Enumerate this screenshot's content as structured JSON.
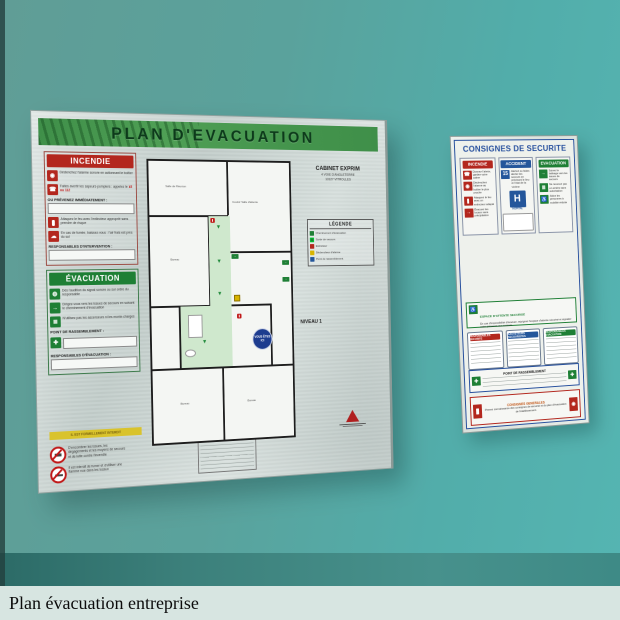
{
  "caption": {
    "text": "Plan évacuation entreprise"
  },
  "board": {
    "title": "PLAN  D'EVACUATION",
    "client_name": "CABINET EXPRIM",
    "client_address1": "4 VOIE D'ANGLETERRE",
    "client_address2": "13127 VITROLLES",
    "level": "NIVEAU 1",
    "incendie": {
      "header": "INCENDIE",
      "row1": "Déclenchez l'alarme sonore en actionnant le boîtier",
      "row2": "Faites avertir les sapeurs-pompiers : appelez le ",
      "row2_numbers": "18 ou 112",
      "notify": "OU PRÉVENEZ IMMÉDIATEMENT :",
      "row3": "Attaquez le feu avec l'extincteur approprié sans prendre de risque",
      "row4": "En cas de fumée, baissez-vous : l'air frais est près du sol",
      "responsables": "RESPONSABLES D'INTERVENTION :"
    },
    "evacuation": {
      "header": "ÉVACUATION",
      "row1": "Dès l'audition du signal sonore ou sur ordre du responsable",
      "row2": "Dirigez-vous vers les issues de secours en suivant le cheminement d'évacuation",
      "row3": "N'utilisez pas les ascenseurs ni les monte-charges",
      "rassemblement": "POINT DE RASSEMBLEMENT :",
      "responsables": "RESPONSABLES D'ÉVACUATION :"
    },
    "interdit": {
      "bar": "IL EST FORMELLEMENT INTERDIT",
      "row1": "D'encombrer les issues, les dégagements et les moyens de secours et de lutte contre l'incendie",
      "row2": "Il est interdit de fumer et d'utiliser une flamme nue dans les locaux"
    },
    "plan": {
      "room1": "Salle de Réunion",
      "room2": "Couloir Salle d'attente",
      "room3": "Bureau",
      "room4": "Accueil",
      "room5": "Bureau",
      "room6": "Bureau",
      "you_are_here": "VOUS ÊTES ICI",
      "exit_label": "→"
    },
    "legende": {
      "header": "LÉGENDE",
      "item1": "Cheminement d'évacuation",
      "item2": "Sortie de secours",
      "item3": "Extincteur",
      "item4": "Déclencheur d'alarme",
      "item5": "Point de rassemblement"
    }
  },
  "sign": {
    "title": "CONSIGNES DE SECURITE",
    "incendie": {
      "header": "INCENDIE",
      "row1": "Donnez l'alerte, gardez votre calme",
      "row2": "Déclenchez l'alarme au boîtier le plus proche",
      "row3": "Attaquez le feu avec un extincteur adapté",
      "row4": "Évacuez les locaux sans précipitation"
    },
    "accident": {
      "header": "ACCIDENT",
      "samu": "15",
      "row1": "Alertez ou faites alerter les secours en précisant le lieu et l'état de la victime",
      "hospital": "H",
      "hospital_label": "HOPITAL"
    },
    "evac": {
      "header": "EVACUATION",
      "row1": "Suivez le balisage vers les issues de secours",
      "row2": "Ne revenez pas en arrière sans autorisation",
      "row3": "Aidez les personnes à mobilité réduite"
    },
    "espace": {
      "header": "ESPACE D'ATTENTE SECURISE",
      "text": "En cas d'impossibilité d'évacuer, rejoignez l'espace d'attente sécurisé et signalez votre présence aux secours."
    },
    "box1": "RESPONSABLES SECURITE",
    "box2": "SAUVETEURS SECOURISTES",
    "box3": "RESPONSABLES EVACUATION",
    "rassemblement": "POINT DE RASSEMBLEMENT",
    "generales": {
      "header": "CONSIGNES GENERALES",
      "text": "Prenez connaissance des consignes de sécurité et du plan d'évacuation de l'établissement."
    }
  },
  "colors": {
    "wall": "#55b0ac",
    "board_green": "#3f8f49",
    "red": "#b3271e",
    "blue": "#24569b",
    "green": "#1e7f35"
  }
}
